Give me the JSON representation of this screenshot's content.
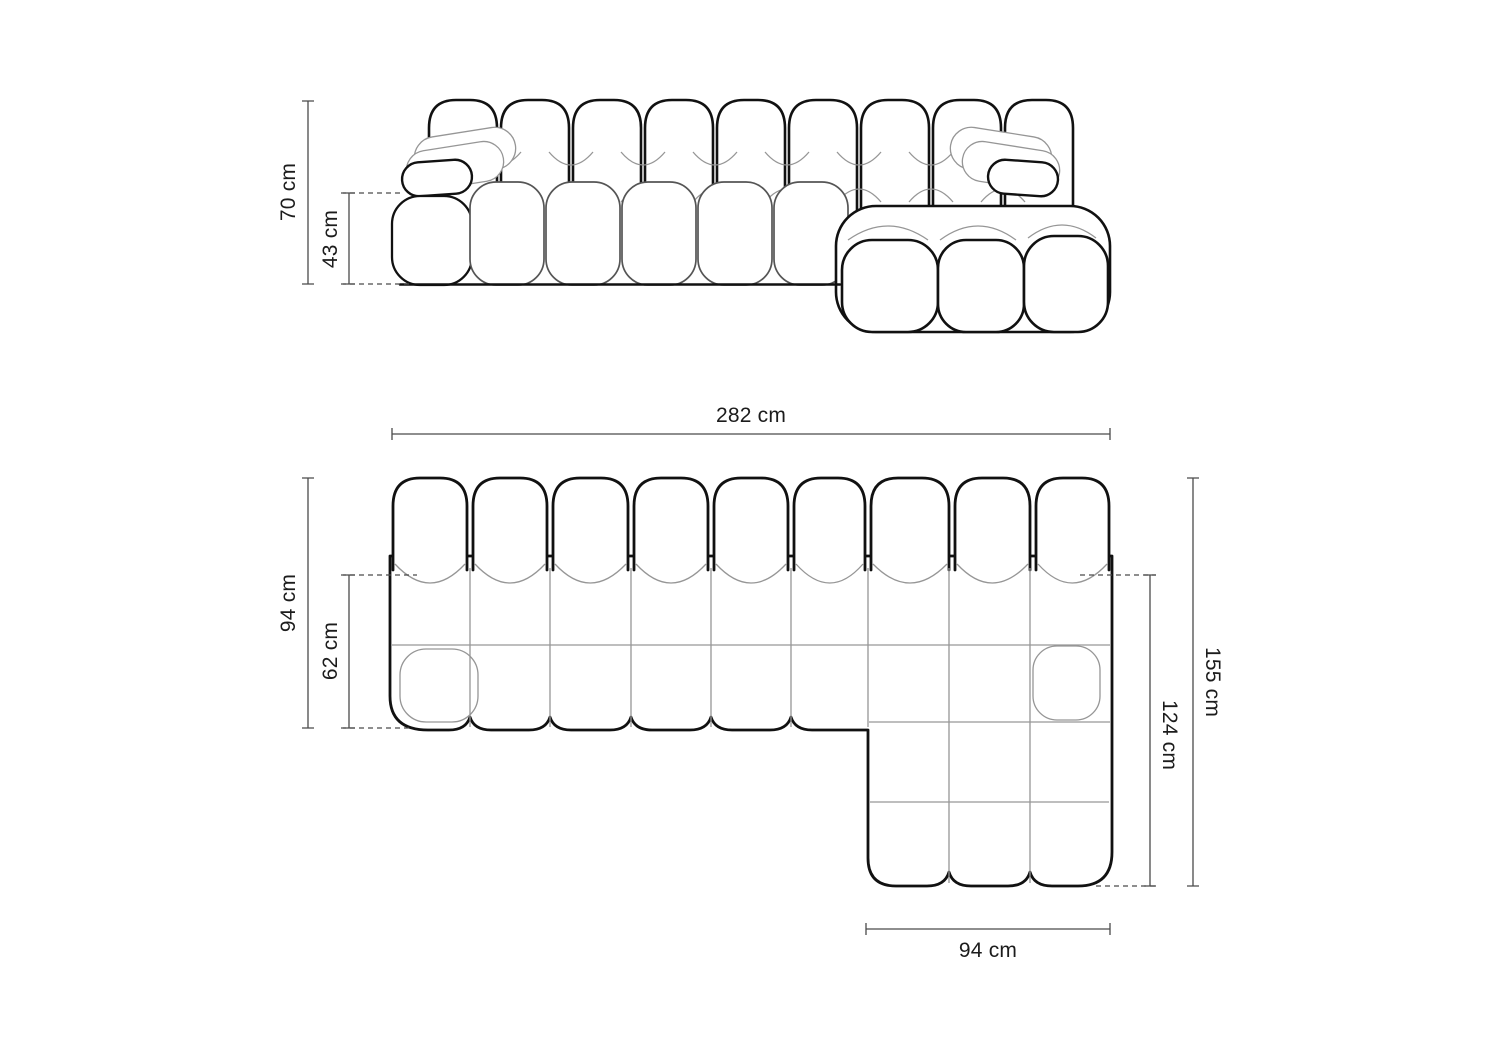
{
  "colors": {
    "background": "#ffffff",
    "outline": "#111111",
    "seat_line": "#555555",
    "seam": "#969696",
    "dimension_line": "#4a4a4a",
    "label_text": "#1c1c1c"
  },
  "front_view": {
    "total_height_label": "70 cm",
    "arm_height_label": "43 cm"
  },
  "plan_view": {
    "total_width_label": "282 cm",
    "depth_label": "94 cm",
    "seat_depth_label": "62 cm",
    "total_length_label": "155 cm",
    "chaise_length_label": "124 cm",
    "chaise_width_label": "94 cm"
  }
}
